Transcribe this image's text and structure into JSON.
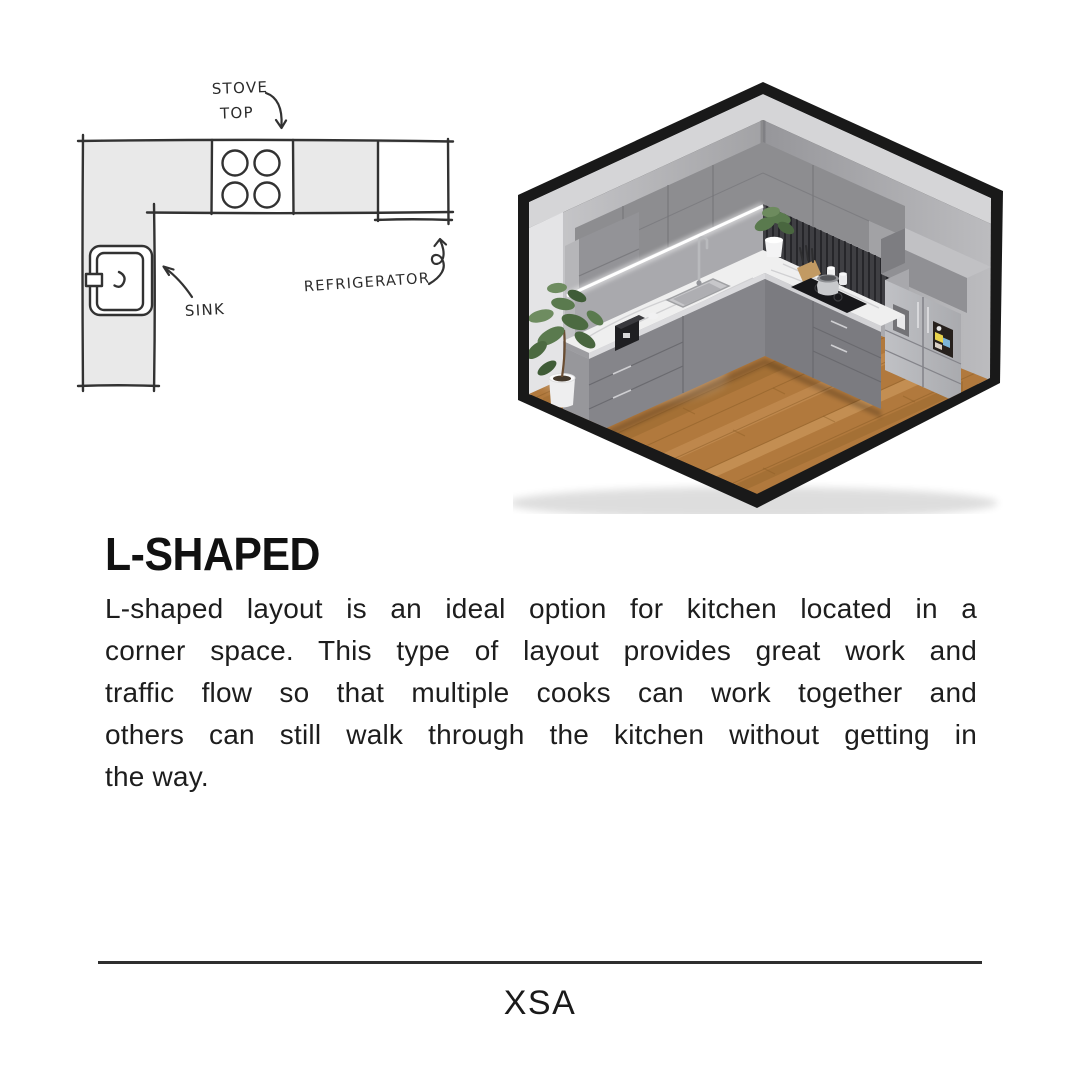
{
  "title": "L-SHAPED",
  "body_lines": [
    "L-shaped layout is an ideal option for kitchen located in a",
    "corner space. This type of layout provides great work and",
    "traffic flow so that multiple cooks can work together and",
    "others can still walk through the kitchen without getting in",
    "the way."
  ],
  "footer_brand": "XSA",
  "floor_plan": {
    "label_stove_line1": "STOVE",
    "label_stove_line2": "TOP",
    "label_refrigerator": "REFRIGERATOR",
    "label_sink": "SINK",
    "colors": {
      "counter_fill": "#e9e9e9",
      "line": "#323232"
    }
  },
  "render": {
    "subject": "isometric L-shaped kitchen cutaway",
    "colors": {
      "frame": "#191919",
      "wall_band": "#d5d5d7",
      "wall_left": "#c4c4c7",
      "wall_right": "#9b9b9e",
      "cabinet_gray": "#8d8d90",
      "countertop": "#efefef",
      "backsplash": "#3f3f43",
      "floor_wood": "#b1793d",
      "fridge_steel": "#b3b4b8",
      "led_light": "#ffffff",
      "plant_green": "#5a7a4e"
    }
  }
}
